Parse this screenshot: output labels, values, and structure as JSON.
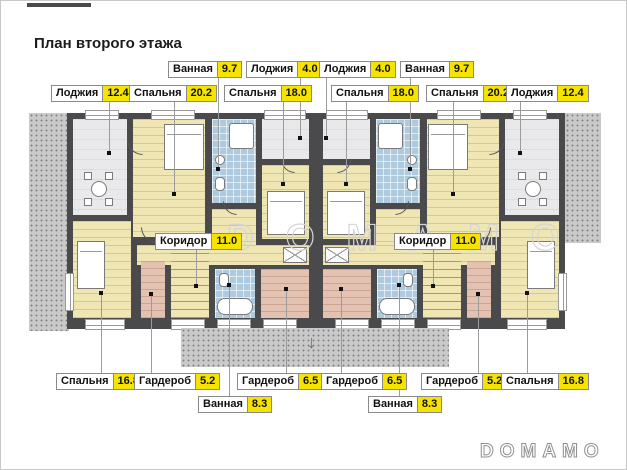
{
  "page": {
    "title": "План второго этажа",
    "watermark": "DOMAMO",
    "logo": "DOMAMO",
    "arrow_icon": "↓"
  },
  "colors": {
    "wall": "#4a4a4c",
    "floor_wood": "#efe6b4",
    "floor_loggia": "#e9e9eb",
    "floor_bath": "#aecadf",
    "floor_wardrobe": "#e3c2b2",
    "roof_hatch": "#c9c9c9",
    "label_value_bg": "#f6e300"
  },
  "labels": [
    {
      "room": "Ванная",
      "area": "9.7"
    },
    {
      "room": "Лоджия",
      "area": "4.0"
    },
    {
      "room": "Лоджия",
      "area": "4.0"
    },
    {
      "room": "Ванная",
      "area": "9.7"
    },
    {
      "room": "Лоджия",
      "area": "12.4"
    },
    {
      "room": "Спальня",
      "area": "20.2"
    },
    {
      "room": "Спальня",
      "area": "18.0"
    },
    {
      "room": "Спальня",
      "area": "18.0"
    },
    {
      "room": "Спальня",
      "area": "20.2"
    },
    {
      "room": "Лоджия",
      "area": "12.4"
    },
    {
      "room": "Коридор",
      "area": "11.0"
    },
    {
      "room": "Коридор",
      "area": "11.0"
    },
    {
      "room": "Спальня",
      "area": "16.8"
    },
    {
      "room": "Гардероб",
      "area": "5.2"
    },
    {
      "room": "Гардероб",
      "area": "6.5"
    },
    {
      "room": "Гардероб",
      "area": "6.5"
    },
    {
      "room": "Гардероб",
      "area": "5.2"
    },
    {
      "room": "Спальня",
      "area": "16.8"
    },
    {
      "room": "Ванная",
      "area": "8.3"
    },
    {
      "room": "Ванная",
      "area": "8.3"
    }
  ]
}
